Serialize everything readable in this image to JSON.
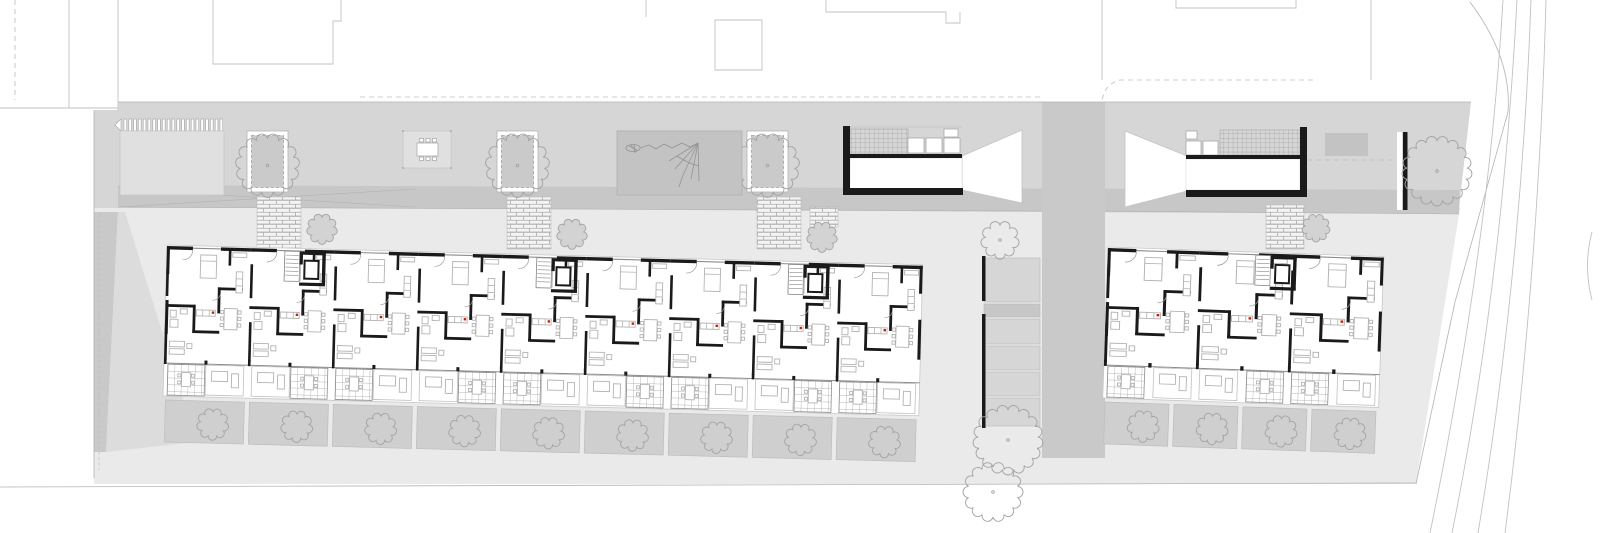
{
  "canvas": {
    "width": 1600,
    "height": 533
  },
  "plan": {
    "kind": "architectural-site-plan-ground-floor",
    "visible_text_labels": [],
    "features": [
      "context-buildings",
      "courtyard-band",
      "bike-racks",
      "tree-planters",
      "picnic-table",
      "play-area-climbing-net",
      "garage-ramps",
      "bicycle-sheds",
      "brick-entry-paths",
      "west-apartment-building",
      "east-apartment-building",
      "private-garden-plots",
      "street-with-lane-lines"
    ]
  },
  "colors": {
    "wall": "#1a1a1a",
    "thin": "#8c8c8c",
    "furn": "#b3b3b3",
    "furn2": "#c0c0c0",
    "tree": "#a3a3a3",
    "treefill": "#d3d3d3",
    "red": "#c42200",
    "band": "#d6d6d6",
    "bandlight": "#e0e0e0",
    "walkway": "#c7c7c7",
    "road": "#c9c9c9",
    "yard": "#eaeaea",
    "plot": "#cfcfcf",
    "play": "#c3c3c3",
    "ctx": "#c2c2c2",
    "dash": "#bdbdbd",
    "brickline": "#ababab",
    "grid": "#9b9b9b",
    "planter": "#cacaca",
    "edge": "#b3b3b3",
    "darkstrip": "#c9c9c9",
    "wedge": "#dcdcdc"
  },
  "courtyard": {
    "bike_rack": {
      "x": 121,
      "y": 119,
      "bar_count": 21,
      "bar_w": 2.7,
      "pitch": 4.8,
      "bar_h": 12
    },
    "light_panel": {
      "x": 120,
      "y": 131,
      "w": 104,
      "h": 64
    },
    "planters": [
      {
        "x": 247,
        "y": 131
      },
      {
        "x": 497,
        "y": 131
      },
      {
        "x": 747,
        "y": 131
      }
    ],
    "planter": {
      "w": 41,
      "h": 61,
      "inset": 4.5
    },
    "picnic_area": {
      "x": 403,
      "y": 131,
      "w": 48,
      "h": 37
    },
    "play_area": {
      "x": 617,
      "y": 131,
      "w": 125,
      "h": 64
    },
    "gray_pad": {
      "x": 1325,
      "y": 133,
      "w": 43,
      "h": 23
    },
    "tree_wall": {
      "x": 1403,
      "y": 132,
      "h": 78
    },
    "band_tree": {
      "cx": 1437,
      "cy": 171,
      "r": 30
    }
  },
  "entry_paths": [
    {
      "x": 257,
      "y": 197,
      "w": 44,
      "h": 52
    },
    {
      "x": 507,
      "y": 197,
      "w": 44,
      "h": 52
    },
    {
      "x": 757,
      "y": 197,
      "w": 44,
      "h": 52
    },
    {
      "x": 810,
      "y": 207,
      "w": 28,
      "h": 20
    },
    {
      "x": 1266,
      "y": 205,
      "w": 38,
      "h": 44
    }
  ],
  "entry_trees": [
    {
      "cx": 322,
      "cy": 229,
      "r": 12
    },
    {
      "cx": 572,
      "cy": 234,
      "r": 12
    },
    {
      "cx": 822,
      "cy": 237,
      "r": 12
    },
    {
      "cx": 1316,
      "cy": 228,
      "r": 11
    }
  ],
  "mid_strip": {
    "x": 984,
    "w": 56,
    "bands": [
      {
        "y": 258,
        "h": 44,
        "dark": false
      },
      {
        "y": 304,
        "h": 13,
        "dark": true
      },
      {
        "y": 319,
        "h": 25,
        "dark": false
      },
      {
        "y": 346,
        "h": 24,
        "dark": false
      },
      {
        "y": 372,
        "h": 24,
        "dark": false
      },
      {
        "y": 398,
        "h": 28,
        "dark": false
      }
    ],
    "wall_x": 982,
    "wall_segments": [
      [
        256,
        301
      ],
      [
        314,
        428
      ]
    ],
    "trees": [
      {
        "cx": 1000,
        "cy": 240,
        "r": 15
      },
      {
        "cx": 1008,
        "cy": 440,
        "r": 30
      },
      {
        "cx": 993,
        "cy": 492,
        "r": 25
      }
    ]
  },
  "buildings": [
    {
      "name": "west-building",
      "x": 167,
      "y": 246,
      "rotation": 1.5,
      "modules": 9,
      "module_w": 84,
      "cores": [
        118,
        370,
        622
      ],
      "garden_plots": 9
    },
    {
      "name": "east-building",
      "x": 1108,
      "y": 248,
      "rotation": 2.0,
      "modules": 3,
      "module_w": 92,
      "cores": [
        148
      ],
      "garden_plots": 4
    }
  ]
}
